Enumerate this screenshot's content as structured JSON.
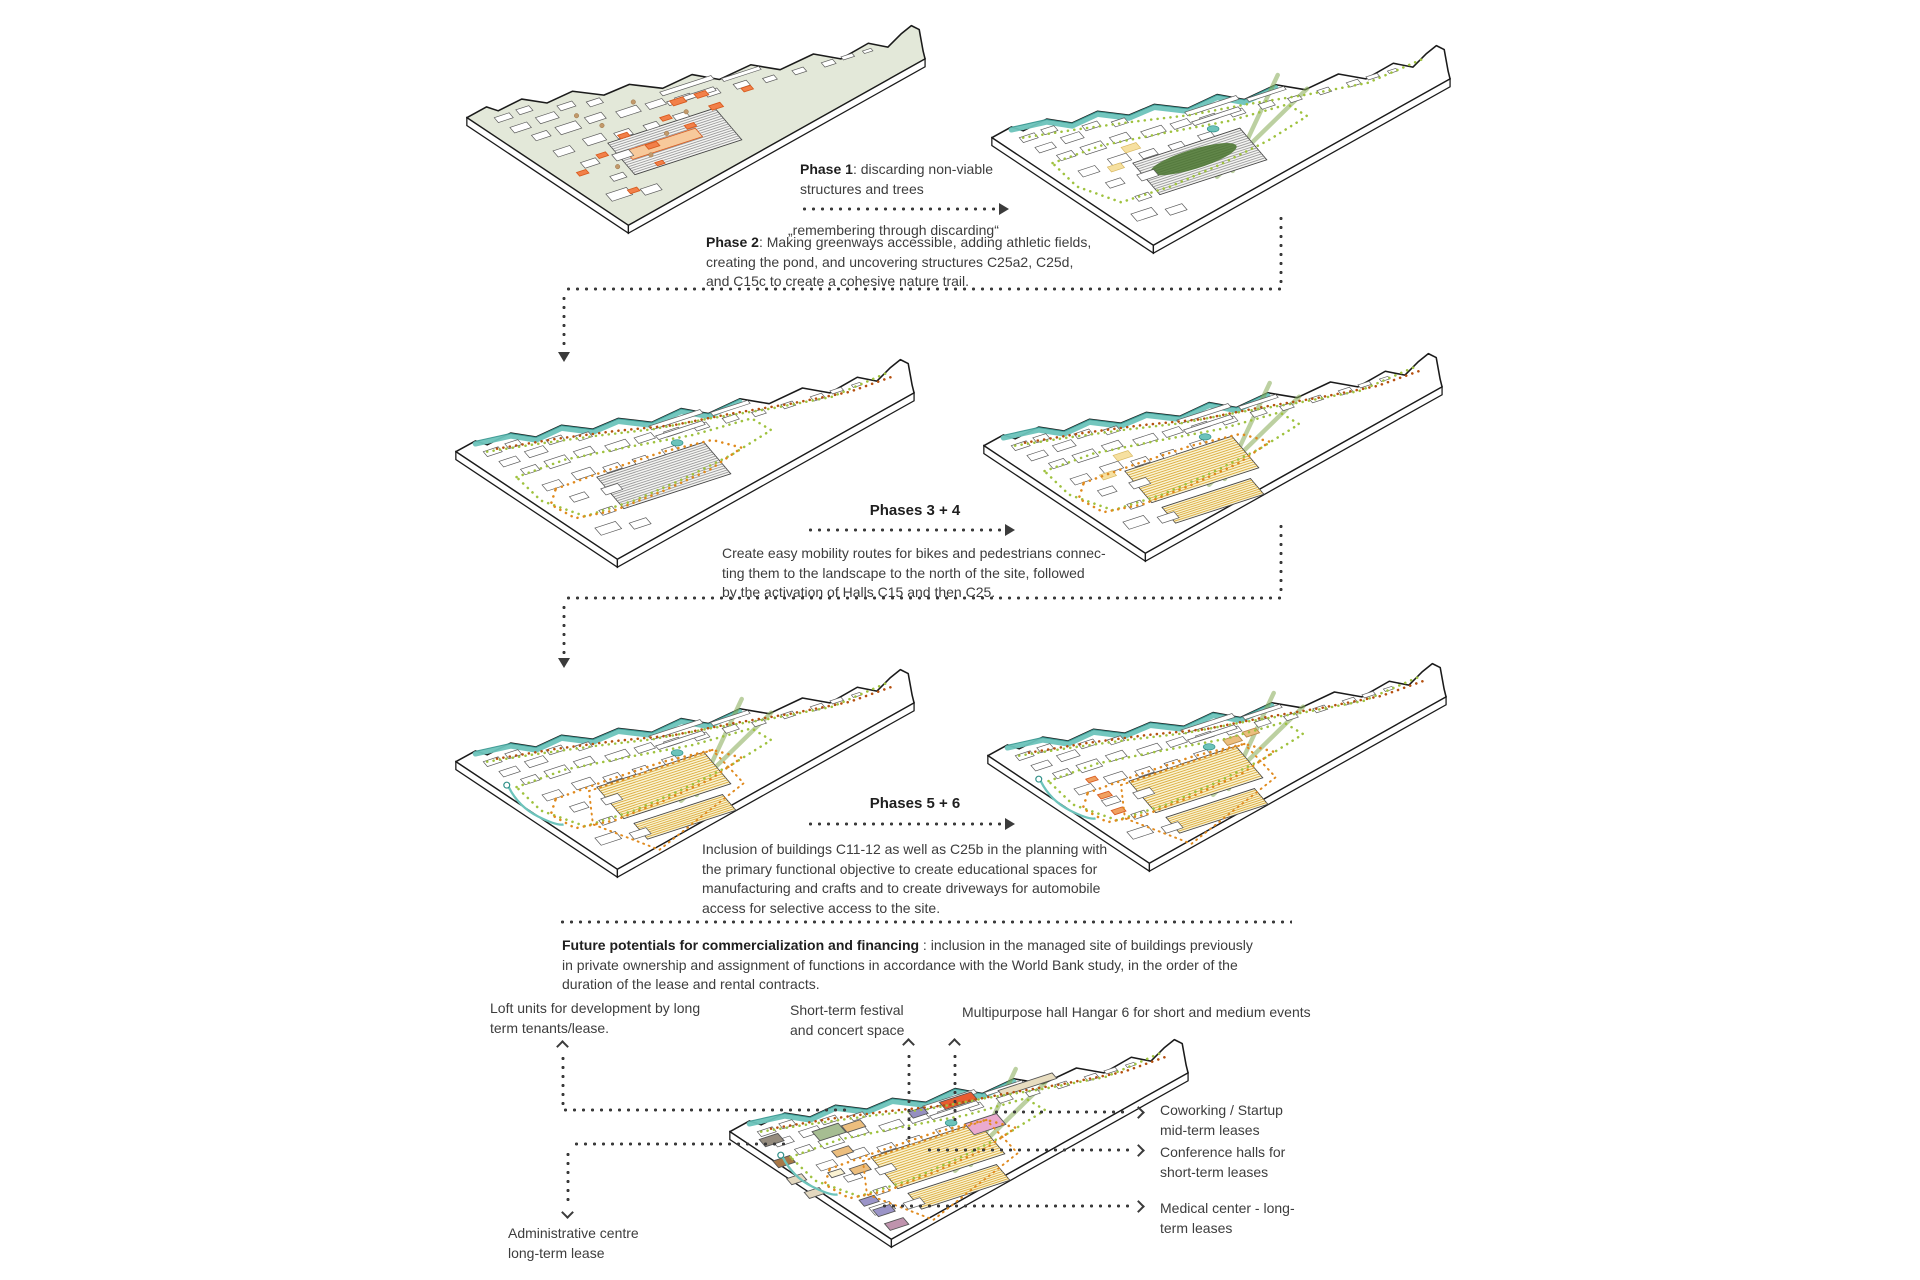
{
  "page": {
    "background": "#ffffff"
  },
  "colors": {
    "ink": "#3d3d3d",
    "terrain_green": "#e3e8d9",
    "accent_orange": "#f28049",
    "accent_orange_stroke": "#d85a1e",
    "peach": "#f7c99b",
    "teal": "#6cc3bb",
    "teal_dark": "#2f8f88",
    "trail_green": "#9fc23f",
    "trail_orange": "#e08a1e",
    "trail_red": "#b5500f",
    "path_green": "#86ab55",
    "hall_yellow_fill": "#fbf3d3",
    "hall_yellow_stripe": "#d9ac3e",
    "blob_green": "#47722c",
    "pink": "#eaaacf",
    "purple": "#9b94c8",
    "mauve": "#bf93ad",
    "green_building": "#a6bd92",
    "tan": "#ecbe7e",
    "brown": "#a87848",
    "gray_building": "#958c7e",
    "cream": "#e3d8bf",
    "beige": "#e8ddc0",
    "lavender": "#958fc0",
    "red_hall": "#e85c30"
  },
  "phase1": {
    "lines": [
      {
        "b": "Phase 1",
        "t": ": discarding non-viable"
      },
      {
        "t": "structures and trees"
      }
    ],
    "quote": "„remembering through discarding“"
  },
  "phase2": {
    "lines": [
      {
        "b": "Phase 2",
        "t": ": Making greenways accessible, adding athletic fields,"
      },
      {
        "t": "creating the pond, and uncovering structures C25a2, C25d,"
      },
      {
        "t": "and C15c to create a cohesive nature trail."
      }
    ]
  },
  "phases34": {
    "title": "Phases 3 + 4",
    "lines": [
      {
        "t": "Create easy mobility routes for bikes and pedestrians connec-"
      },
      {
        "t": "ting them to the landscape to the north of the site, followed"
      },
      {
        "t": "by the activation of Halls C15 and then C25."
      }
    ]
  },
  "phases56": {
    "title": "Phases 5 + 6",
    "lines": [
      {
        "t": "Inclusion of buildings C11-12 as well as C25b in the planning with"
      },
      {
        "t": "the primary functional objective to create educational spaces for"
      },
      {
        "t": "manufacturing and crafts and to create driveways for automobile"
      },
      {
        "t": "access for selective access to the site."
      }
    ]
  },
  "future": {
    "lines": [
      {
        "b": "Future potentials for commercialization and financing",
        "t": " : inclusion in the managed site of buildings previously"
      },
      {
        "t": "in private ownership and assignment of functions in accordance with the World Bank study, in the order of the"
      },
      {
        "t": "duration of the lease and rental contracts."
      }
    ]
  },
  "bottom_labels": {
    "loft": {
      "lines": [
        {
          "t": "Loft units for development by long"
        },
        {
          "t": "term tenants/lease."
        }
      ]
    },
    "festival": {
      "lines": [
        {
          "t": "Short-term festival"
        },
        {
          "t": "and concert space"
        }
      ]
    },
    "multipurpose": {
      "lines": [
        {
          "t": "Multipurpose hall Hangar 6 for short and medium events"
        }
      ]
    },
    "coworking": {
      "lines": [
        {
          "t": "Coworking / Startup"
        },
        {
          "t": "mid-term leases"
        }
      ]
    },
    "conference": {
      "lines": [
        {
          "t": "Conference halls for"
        },
        {
          "t": "short-term leases"
        }
      ]
    },
    "medical": {
      "lines": [
        {
          "t": "Medical center - long-"
        },
        {
          "t": "term leases"
        }
      ]
    },
    "admin": {
      "lines": [
        {
          "t": "Administrative centre"
        },
        {
          "t": "long-term lease"
        }
      ]
    }
  },
  "maps": [
    {
      "name": "site-map-existing",
      "x": 459,
      "y": 8,
      "w": 470,
      "features": {
        "terrain": true,
        "orange": true,
        "trees": true,
        "hall": "gray",
        "peach": true
      }
    },
    {
      "name": "site-map-phase-1-2",
      "x": 984,
      "y": 28,
      "w": 470,
      "features": {
        "river": true,
        "gtrails": true,
        "cross": true,
        "hall": "gray",
        "blob": true,
        "pond": true,
        "ypatch": true
      }
    },
    {
      "name": "site-map-phase-3",
      "x": 448,
      "y": 342,
      "w": 470,
      "features": {
        "river": true,
        "gtrails": true,
        "otrail": true,
        "rtrail": true,
        "hall": "gray",
        "pond": true
      }
    },
    {
      "name": "site-map-phase-4",
      "x": 976,
      "y": 336,
      "w": 470,
      "features": {
        "river": true,
        "gtrails": true,
        "otrail": true,
        "rtrail": true,
        "cross": true,
        "hall": "yellow",
        "pond": true,
        "ypatch": true
      }
    },
    {
      "name": "site-map-phase-5",
      "x": 448,
      "y": 652,
      "w": 470,
      "features": {
        "river": true,
        "gtrails": true,
        "otrail": true,
        "rtrail": true,
        "cross": true,
        "hall": "yellow",
        "outline": true,
        "pond": true,
        "stream": true
      }
    },
    {
      "name": "site-map-phase-6",
      "x": 980,
      "y": 646,
      "w": 470,
      "features": {
        "river": true,
        "gtrails": true,
        "otrail": true,
        "rtrail": true,
        "cross": true,
        "hall": "yellow",
        "outline": true,
        "extras": true,
        "pond": true,
        "stream": true
      }
    },
    {
      "name": "site-map-future-program",
      "x": 722,
      "y": 1022,
      "w": 470,
      "features": {
        "river": true,
        "gtrails": true,
        "otrail": true,
        "rtrail": true,
        "cross": true,
        "hall": "yellow",
        "outline": true,
        "program": true,
        "pond": true,
        "stream": true
      }
    }
  ]
}
